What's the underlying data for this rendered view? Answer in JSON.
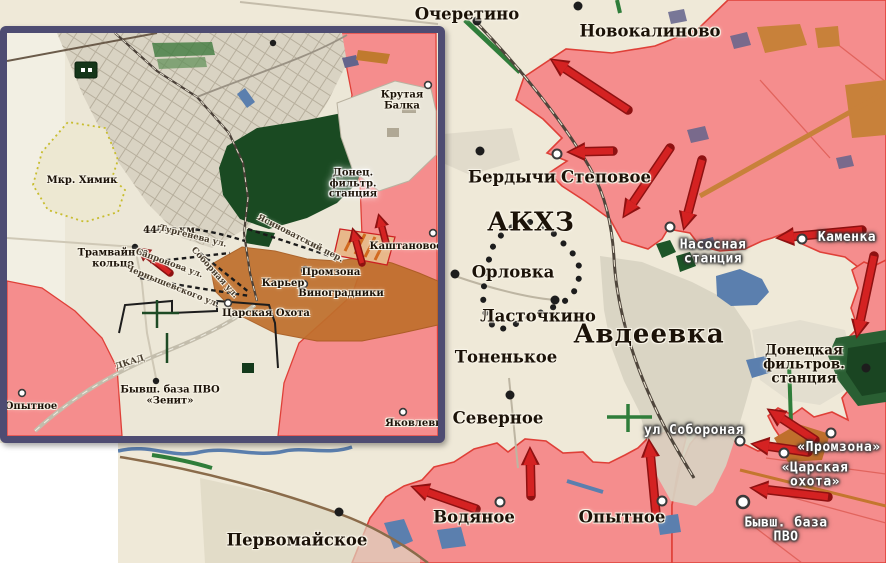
{
  "colors": {
    "friendly_area": "#f58d8d",
    "area_border": "#df4038",
    "advance_zone": "#bf6f2c",
    "arrow": "#d42222",
    "arrow_outline": "#8e1111",
    "forest": "#1a4a22",
    "water": "#5b7fae",
    "urban": "#d8d2c2",
    "background": "#efe9d8",
    "inset_border": "#4e4c72",
    "dotted_outline": "#1d1d1d",
    "yellow_outline": "#c8bd2f"
  },
  "main_map": {
    "labels": [
      {
        "text": "Очеретино",
        "x": 467,
        "y": 14,
        "s": "town"
      },
      {
        "text": "Новокалиново",
        "x": 650,
        "y": 31,
        "s": "town"
      },
      {
        "text": "Бердычи",
        "x": 512,
        "y": 177,
        "s": "town"
      },
      {
        "text": "Степовое",
        "x": 606,
        "y": 177,
        "s": "town"
      },
      {
        "text": "АКХЗ",
        "x": 531,
        "y": 223,
        "s": "city"
      },
      {
        "text": "Орловка",
        "x": 513,
        "y": 272,
        "s": "town"
      },
      {
        "text": "Ласточкино",
        "x": 538,
        "y": 316,
        "s": "town"
      },
      {
        "text": "Авдеевка",
        "x": 649,
        "y": 335,
        "s": "city"
      },
      {
        "text": "Тоненькое",
        "x": 506,
        "y": 357,
        "s": "town"
      },
      {
        "text": "Насосная\nстанция",
        "x": 713,
        "y": 252,
        "s": "obj"
      },
      {
        "text": "Каменка",
        "x": 847,
        "y": 238,
        "s": "obj"
      },
      {
        "text": "Донецкая\nфильтров.\nстанция",
        "x": 804,
        "y": 365,
        "s": "town-sm"
      },
      {
        "text": "Северное",
        "x": 498,
        "y": 418,
        "s": "town"
      },
      {
        "text": "ул Собороная",
        "x": 694,
        "y": 431,
        "s": "obj"
      },
      {
        "text": "«Промзона»",
        "x": 839,
        "y": 448,
        "s": "obj"
      },
      {
        "text": "«Царская охота»",
        "x": 815,
        "y": 475,
        "s": "obj"
      },
      {
        "text": "Бывш. база ПВО",
        "x": 786,
        "y": 530,
        "s": "obj"
      },
      {
        "text": "Водяное",
        "x": 474,
        "y": 517,
        "s": "town"
      },
      {
        "text": "Опытное",
        "x": 622,
        "y": 517,
        "s": "town"
      },
      {
        "text": "Первомайское",
        "x": 297,
        "y": 540,
        "s": "town"
      }
    ]
  },
  "inset": {
    "labels": [
      {
        "text": "Мкр. Химик",
        "x": 75,
        "y": 148,
        "s": "ins"
      },
      {
        "text": "447-я км",
        "x": 162,
        "y": 198,
        "s": "ins"
      },
      {
        "text": "Трамвайное\nкольцо",
        "x": 106,
        "y": 226,
        "s": "ins"
      },
      {
        "text": "Тургенева ул.",
        "x": 186,
        "y": 204,
        "s": "street",
        "r": 14
      },
      {
        "text": "Сапронова ул.",
        "x": 162,
        "y": 231,
        "s": "street",
        "r": 20
      },
      {
        "text": "Соборная ул.",
        "x": 207,
        "y": 240,
        "s": "street",
        "r": 48
      },
      {
        "text": "Чернышевского ул.",
        "x": 165,
        "y": 254,
        "s": "street",
        "r": 22
      },
      {
        "text": "Ясиноватский пер.",
        "x": 293,
        "y": 206,
        "s": "street",
        "r": 27
      },
      {
        "text": "Донец.\nфильтр.\nстанция",
        "x": 346,
        "y": 151,
        "s": "ins-glow"
      },
      {
        "text": "Каштановое",
        "x": 399,
        "y": 214,
        "s": "ins"
      },
      {
        "text": "Промзона",
        "x": 324,
        "y": 240,
        "s": "ins"
      },
      {
        "text": "Карьер",
        "x": 276,
        "y": 251,
        "s": "ins"
      },
      {
        "text": "Виноградники",
        "x": 334,
        "y": 261,
        "s": "ins"
      },
      {
        "text": "Царская Охота",
        "x": 259,
        "y": 281,
        "s": "ins"
      },
      {
        "text": "ДКАД",
        "x": 123,
        "y": 330,
        "s": "street",
        "r": -18
      },
      {
        "text": "Бывш. база ПВО\n«Зенит»",
        "x": 163,
        "y": 363,
        "s": "ins"
      },
      {
        "text": "Опытное",
        "x": 24,
        "y": 374,
        "s": "ins"
      },
      {
        "text": "Яковлевка",
        "x": 410,
        "y": 391,
        "s": "ins"
      },
      {
        "text": "Крутая Балка",
        "x": 395,
        "y": 68,
        "s": "ins"
      }
    ]
  }
}
